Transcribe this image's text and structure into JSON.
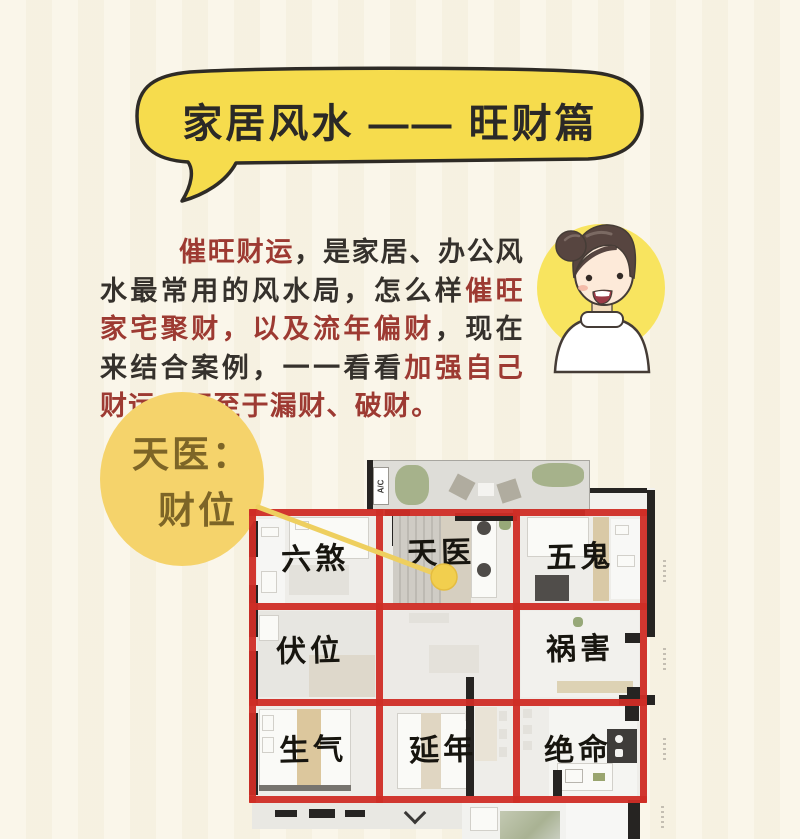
{
  "page": {
    "background": "#f9f4e5"
  },
  "title": {
    "text": "家居风水 —— 旺财篇",
    "bubble_color": "#f6dc4d",
    "outline_color": "#2e2b26",
    "text_color": "#2b2927"
  },
  "intro": {
    "red_color": "#9d3a32",
    "dark_color": "#35312c",
    "runs": [
      {
        "text": "催旺财运",
        "style": "red"
      },
      {
        "text": "，是家居、办公风水最常用的风水局，怎么样",
        "style": "dark"
      },
      {
        "text": "催旺家宅聚财，以及流年偏财",
        "style": "red"
      },
      {
        "text": "，现在来结合案例，一一看看",
        "style": "dark"
      },
      {
        "text": "加强自己财运，不至于漏财、破财。",
        "style": "red"
      }
    ]
  },
  "avatar": {
    "circle_color": "#f8e45f"
  },
  "callout": {
    "line1": "天医：",
    "line2": "财位",
    "circle_color": "#f5d36b",
    "text_color": "#7d6527"
  },
  "plan": {
    "grid_color": "#cf2d26",
    "ac_label": "A/C",
    "labels": [
      {
        "text": "六煞"
      },
      {
        "text": "天医"
      },
      {
        "text": "五鬼"
      },
      {
        "text": "伏位"
      },
      {
        "text": "祸害"
      },
      {
        "text": "生气"
      },
      {
        "text": "延年"
      },
      {
        "text": "绝命"
      }
    ]
  }
}
